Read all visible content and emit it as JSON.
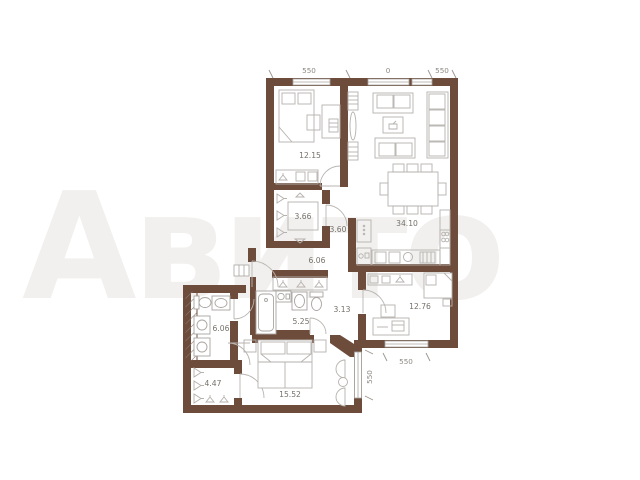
{
  "watermark": {
    "text": "Авито"
  },
  "plan": {
    "rooms": [
      {
        "name": "bedroom-1",
        "area": "12.15"
      },
      {
        "name": "wardrobe-1",
        "area": "3.66"
      },
      {
        "name": "hall-upper",
        "area": "3.60"
      },
      {
        "name": "living-kitchen",
        "area": "34.10"
      },
      {
        "name": "hallway",
        "area": "6.06"
      },
      {
        "name": "corridor",
        "area": "3.13"
      },
      {
        "name": "bathroom-1",
        "area": "5.25"
      },
      {
        "name": "bedroom-2",
        "area": "12.76"
      },
      {
        "name": "bathroom-2",
        "area": "6.06"
      },
      {
        "name": "wardrobe-2",
        "area": "4.47"
      },
      {
        "name": "bedroom-3",
        "area": "15.52"
      }
    ],
    "dimensions": {
      "top": [
        "550",
        "0",
        "550"
      ],
      "bottom": "550",
      "right": "550"
    }
  }
}
